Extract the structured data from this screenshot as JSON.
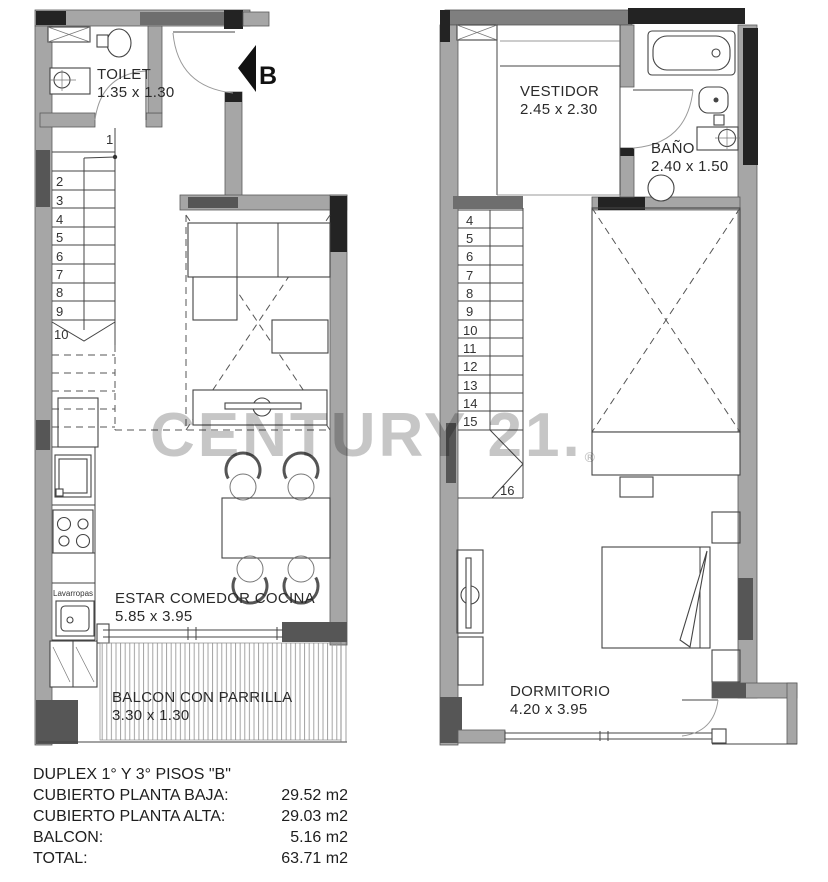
{
  "watermark": {
    "text": "CENTURY 21.",
    "reg": "®",
    "color": "#c6c6c6"
  },
  "plans": {
    "lower": {
      "entry_label": "B",
      "toilet": {
        "name": "TOILET",
        "dims": "1.35 x 1.30"
      },
      "living": {
        "name": "ESTAR COMEDOR COCINA",
        "dims": "5.85 x 3.95"
      },
      "balcony": {
        "name": "BALCON CON PARRILLA",
        "dims": "3.30 x 1.30"
      },
      "laundry_label": "Lavarropas",
      "stairs": [
        "1",
        "2",
        "3",
        "4",
        "5",
        "6",
        "7",
        "8",
        "9",
        "10"
      ]
    },
    "upper": {
      "vestidor": {
        "name": "VESTIDOR",
        "dims": "2.45 x 2.30"
      },
      "bath": {
        "name": "BAÑO",
        "dims": "2.40 x 1.50"
      },
      "bedroom": {
        "name": "DORMITORIO",
        "dims": "4.20 x 3.95"
      },
      "stairs": [
        "4",
        "5",
        "6",
        "7",
        "8",
        "9",
        "10",
        "11",
        "12",
        "13",
        "14",
        "15",
        "16"
      ]
    }
  },
  "summary": {
    "title": "DUPLEX 1° Y 3° PISOS \"B\"",
    "rows": [
      {
        "label": "CUBIERTO PLANTA BAJA:",
        "value": "29.52 m2"
      },
      {
        "label": "CUBIERTO PLANTA ALTA:",
        "value": "29.03 m2"
      },
      {
        "label": "BALCON:",
        "value": "5.16 m2"
      },
      {
        "label": "TOTAL:",
        "value": "63.71 m2"
      }
    ]
  },
  "colors": {
    "wall": "#a6a6a6",
    "wall_dark": "#6e6e6e",
    "wall_black": "#232323",
    "line": "#444444",
    "watermark": "#c6c6c6",
    "background": "#ffffff"
  }
}
